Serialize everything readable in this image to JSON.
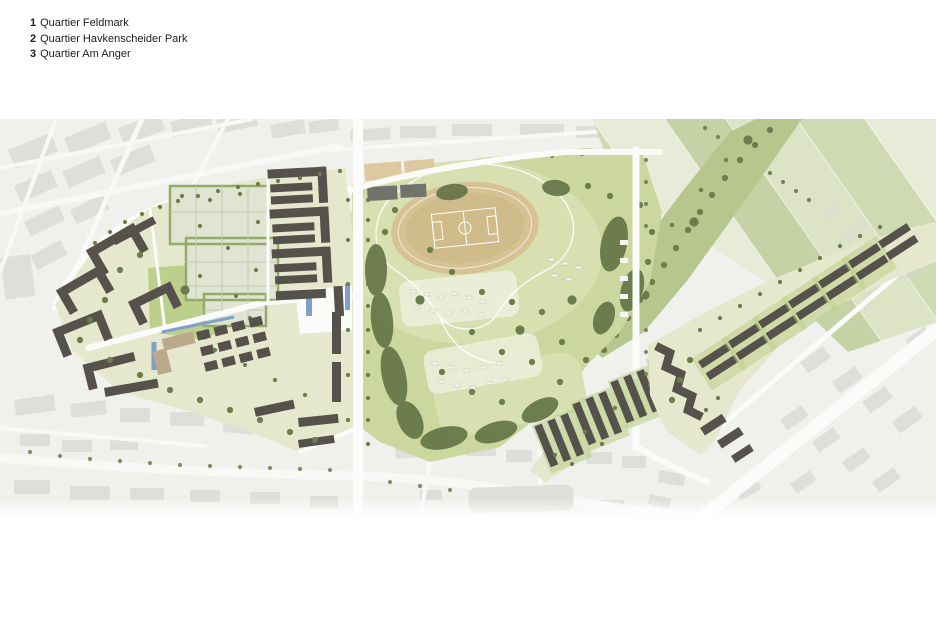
{
  "legend": {
    "items": [
      {
        "num": "1",
        "label": "Quartier Feldmark"
      },
      {
        "num": "2",
        "label": "Quartier Havkenscheider Park"
      },
      {
        "num": "3",
        "label": "Quartier Am Anger"
      }
    ]
  },
  "colors": {
    "page_bg": "#ffffff",
    "text": "#1d1d1b",
    "existing_bg": "#f0f0ed",
    "existing_block": "#d9d9d5",
    "existing_block_dark": "#c9c9c5",
    "road": "#fbfbf9",
    "new_ground": "#e6e8cd",
    "park_green": "#ccd7a0",
    "meadow": "#d8e0b2",
    "lawn": "#bdcf8c",
    "field_a": "#dde4c6",
    "field_b": "#cfdab2",
    "field_c": "#e7ebd8",
    "field_d": "#c6d2a6",
    "corridor": "#b6c68c",
    "tree": "#6d7c4b",
    "tree_dark": "#5f7042",
    "hedge": "#96aa68",
    "garden_fill": "#e0e4d2",
    "garden_line": "#c2cab0",
    "building": "#56514b",
    "building_light": "#b9a88c",
    "water": "#7fa0c8",
    "track": "#d7c295",
    "track_inner": "#d0bc8b",
    "court": "#73736d",
    "sand": "#dcc9a0",
    "pond": "#d8d8d5",
    "shed": "#f6f6f1",
    "allot": "#eff1de"
  }
}
